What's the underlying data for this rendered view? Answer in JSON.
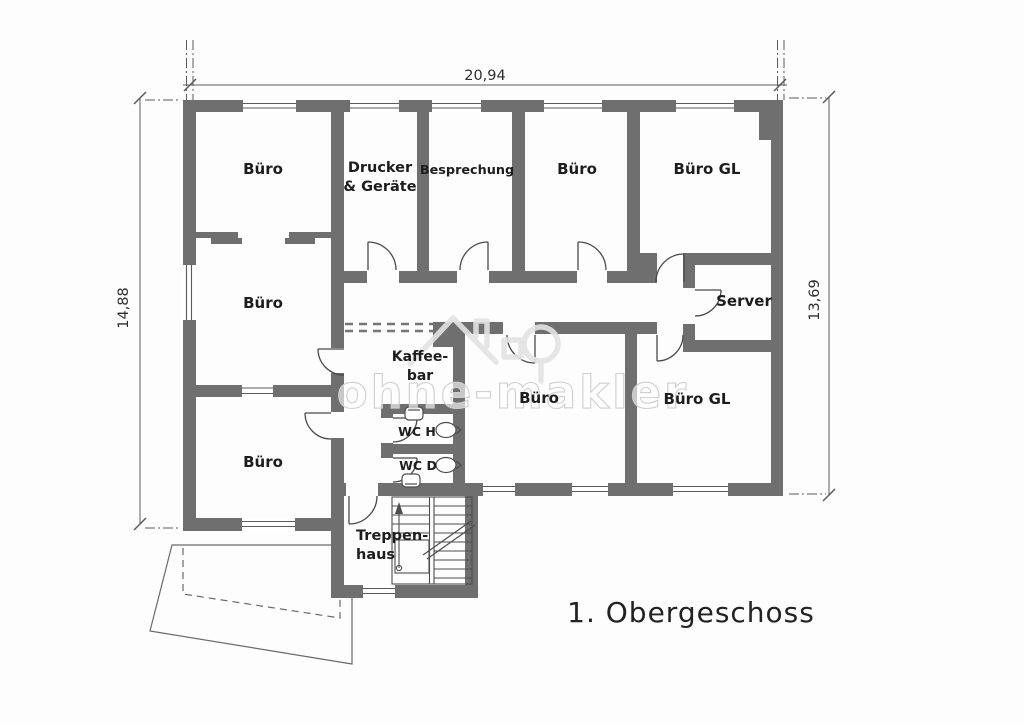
{
  "title": "1. Obergeschoss",
  "watermark": {
    "text": "ohne-makler"
  },
  "dimensions": {
    "top": "20,94",
    "left": "14,88",
    "right": "13,69"
  },
  "rooms": [
    {
      "id": "buero-top-left",
      "label": "Büro"
    },
    {
      "id": "drucker-geraete",
      "label": "Drucker",
      "label2": "& Geräte"
    },
    {
      "id": "besprechung",
      "label": "Besprechung"
    },
    {
      "id": "buero-top-middle",
      "label": "Büro"
    },
    {
      "id": "buero-gl-top",
      "label": "Büro GL"
    },
    {
      "id": "buero-middle-left",
      "label": "Büro"
    },
    {
      "id": "server",
      "label": "Server"
    },
    {
      "id": "kaffeebar",
      "label": "Kaffee-",
      "label2": "bar"
    },
    {
      "id": "buero-middle",
      "label": "Büro"
    },
    {
      "id": "buero-gl-lower",
      "label": "Büro GL"
    },
    {
      "id": "buero-bottom-left",
      "label": "Büro"
    },
    {
      "id": "wc-h",
      "label": "WC H"
    },
    {
      "id": "wc-d",
      "label": "WC D"
    },
    {
      "id": "treppenhaus",
      "label": "Treppen-",
      "label2": "haus"
    }
  ]
}
